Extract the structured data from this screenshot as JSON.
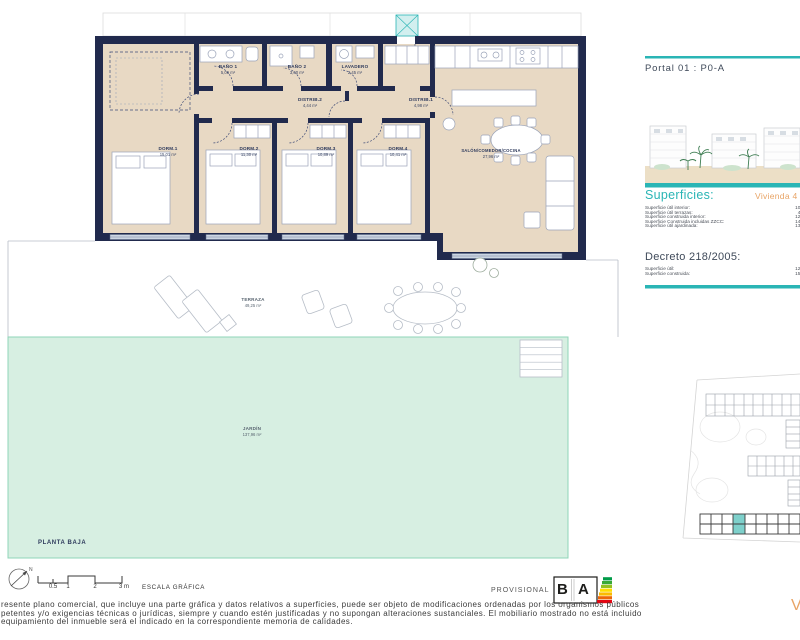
{
  "colors": {
    "teal_accent": "#2ab5b5",
    "orange_accent": "#e8a466",
    "wall_navy": "#212a4d",
    "room_beige": "#e8d9c4",
    "garden_green": "#d7efe2"
  },
  "sidebar": {
    "portal_title": "Portal 01 : P0-A",
    "superficies_heading": "Superficies:",
    "vivienda_label": "Vivienda 4",
    "superficies_rows": [
      {
        "label": "Superficie útil interior:",
        "value": "109"
      },
      {
        "label": "Superficie útil terrazas:",
        "value": "49"
      },
      {
        "label": "Superficie construida interior:",
        "value": "124"
      },
      {
        "label": "Superficie Construida incluidas ZZCC:",
        "value": "142"
      },
      {
        "label": "Superficie útil ajardinada:",
        "value": "137"
      }
    ],
    "decreto_heading": "Decreto 218/2005:",
    "decreto_rows": [
      {
        "label": "Superficie útil:",
        "value": "120"
      },
      {
        "label": "Superficie construida:",
        "value": "156"
      }
    ],
    "vivienda_partial": "V"
  },
  "plan": {
    "floor_label": "PLANTA BAJA",
    "rooms": [
      {
        "name": "BAÑO 1",
        "area": "5,06 m²"
      },
      {
        "name": "BAÑO 2",
        "area": "3,60 m²"
      },
      {
        "name": "LAVADERO",
        "area": "2,45 m²"
      },
      {
        "name": "DISTRIB.2",
        "area": "4,44 m²"
      },
      {
        "name": "DISTRIB.1",
        "area": "4,98 m²"
      },
      {
        "name": "DORM.1",
        "area": "15,01 m²"
      },
      {
        "name": "DORM.2",
        "area": "11,30 m²"
      },
      {
        "name": "DORM.3",
        "area": "10,89 m²"
      },
      {
        "name": "DORM.4",
        "area": "10,41 m²"
      },
      {
        "name": "SALÓN/COMEDOR/COCINA",
        "area": "27,96 m²"
      },
      {
        "name": "TERRAZA",
        "area": "49,25 m²"
      },
      {
        "name": "JARDÍN",
        "area": "137,96 m²"
      }
    ]
  },
  "footer": {
    "north_label": "N",
    "scale_ticks": [
      "0.5",
      "1",
      "2",
      "3 m"
    ],
    "scale_label": "ESCALA GRÁFICA",
    "provisional": "PROVISIONAL",
    "energy_letter_b": "B",
    "energy_letter_a": "A",
    "disclaimer_lines": [
      "resente plano comercial, que incluye una parte gráfica y datos relativos a superficies, puede ser objeto de modificaciones ordenadas por los organismos públicos",
      "petentes y/o exigencias técnicas o jurídicas, siempre y cuando estén justificadas y no supongan alteraciones sustanciales. El mobiliario mostrado no está incluido",
      "equipamiento del inmueble será el indicado en la correspondiente memoria de calidades."
    ]
  }
}
